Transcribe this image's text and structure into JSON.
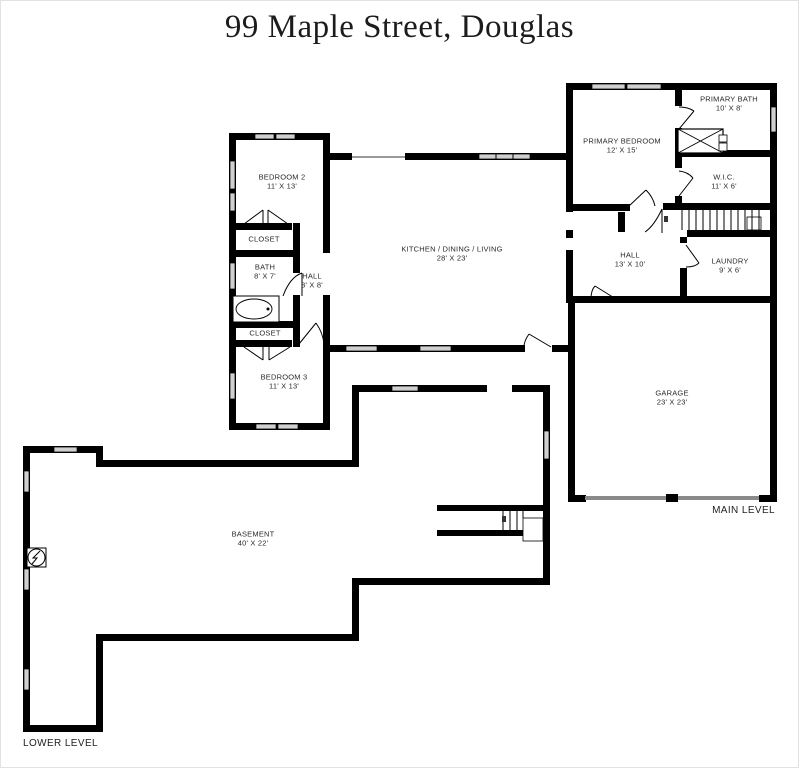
{
  "title": "99 Maple Street, Douglas",
  "levels": {
    "main": "MAIN LEVEL",
    "lower": "LOWER LEVEL"
  },
  "rooms": {
    "primary_bedroom": {
      "name": "PRIMARY BEDROOM",
      "dims": "12' X 15'"
    },
    "primary_bath": {
      "name": "PRIMARY BATH",
      "dims": "10' X 8'"
    },
    "wic": {
      "name": "W.I.C.",
      "dims": "11' X 6'"
    },
    "hall": {
      "name": "HALL",
      "dims": "13' X 10'"
    },
    "laundry": {
      "name": "LAUNDRY",
      "dims": "9' X 6'"
    },
    "garage": {
      "name": "GARAGE",
      "dims": "23' X 23'"
    },
    "kitchen": {
      "name": "KITCHEN / DINING / LIVING",
      "dims": "28' X 23'"
    },
    "bedroom2": {
      "name": "BEDROOM 2",
      "dims": "11' X 13'"
    },
    "closet_a": {
      "name": "CLOSET",
      "dims": ""
    },
    "bath": {
      "name": "BATH",
      "dims": "8' X 7'"
    },
    "hall_small": {
      "name": "HALL",
      "dims": "3' X 8'"
    },
    "closet_b": {
      "name": "CLOSET",
      "dims": ""
    },
    "bedroom3": {
      "name": "BEDROOM 3",
      "dims": "11' X 13'"
    },
    "basement": {
      "name": "BASEMENT",
      "dims": "40' X 22'"
    }
  },
  "colors": {
    "wall": "#000000",
    "window_fill": "#cfcfcf",
    "garage_door": "#8a8a8a",
    "cased_opening": "#999999",
    "background": "#ffffff"
  }
}
